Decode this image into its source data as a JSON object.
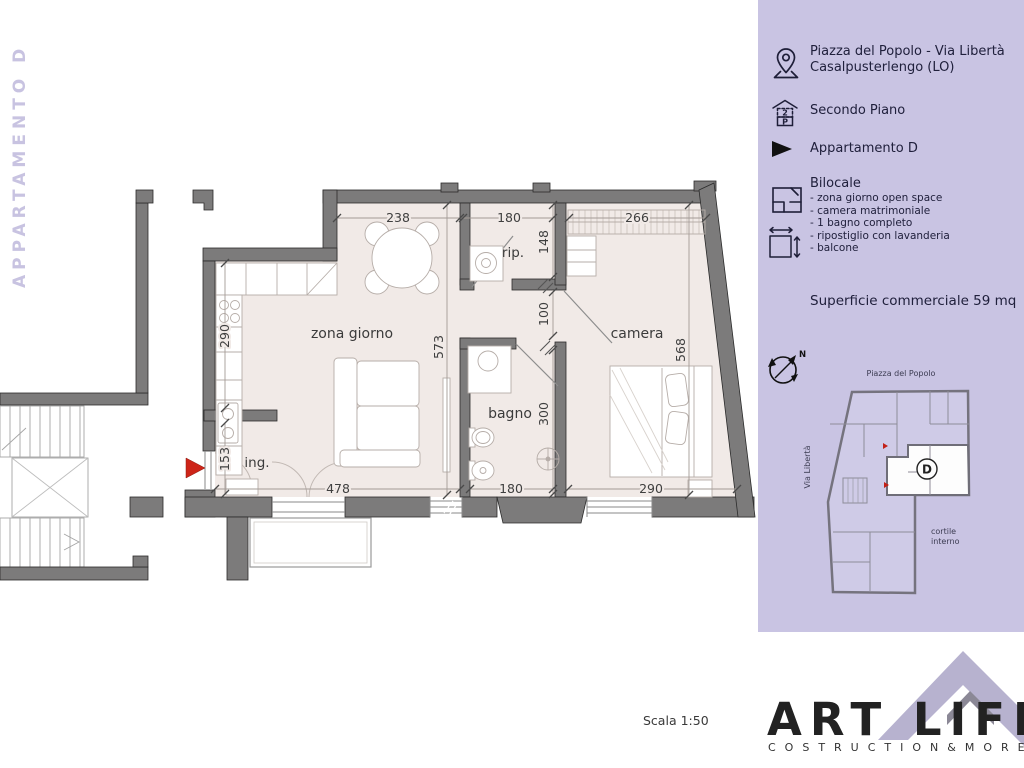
{
  "left_banner": {
    "text": "APPARTAMENTO D"
  },
  "sidebar": {
    "address_line1": "Piazza del Popolo - Via Libertà",
    "address_line2": "Casalpusterlengo (LO)",
    "floor": "Secondo Piano",
    "apartment": "Appartamento D",
    "type_title": "Bilocale",
    "features": [
      "- zona giorno open space",
      "- camera matrimoniale",
      "- 1 bagno completo",
      "- ripostiglio con lavanderia",
      "- balcone"
    ],
    "surface": "Superficie commerciale 59 mq",
    "compass_n": "N",
    "miniplan": {
      "top_label": "Piazza del Popolo",
      "left_label": "Via Libertà",
      "courtyard_line1": "cortile",
      "courtyard_line2": "interno",
      "unit_letter": "D"
    }
  },
  "plan": {
    "rooms": {
      "living": "zona giorno",
      "bedroom": "camera",
      "bath": "bagno",
      "storage": "rip.",
      "entry": "ing."
    },
    "dimensions": {
      "d238": "238",
      "d180_top": "180",
      "d266": "266",
      "d148": "148",
      "d100": "100",
      "d573": "573",
      "d568": "568",
      "d290_left": "290",
      "d153": "153",
      "d300": "300",
      "d478": "478",
      "d180_bottom": "180",
      "d290_bottom": "290"
    }
  },
  "footer": {
    "scale_label": "Scala 1:50",
    "brand": "ART LIFE",
    "brand_sub": "COSTRUCTION&MORE"
  },
  "colors": {
    "sidebar_bg": "#c9c4e3",
    "wall_gray": "#7c7b7b",
    "floor_pink": "#f1eae7",
    "accent_red": "#cd2418",
    "banner_lavender": "#c8c3e1",
    "roof_lavender": "#b7b2cf"
  }
}
